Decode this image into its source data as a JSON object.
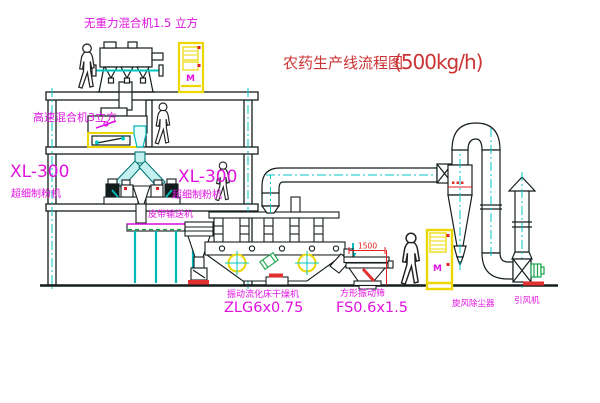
{
  "title": {
    "name": "农药生产线流程图",
    "capacity": "(500kg/h)"
  },
  "labels": {
    "gravity_mixer": "无重力混合机1.5 立方",
    "high_speed_mixer": "高速混合机3立方",
    "mill_left_model": "XL-300",
    "mill_left_name": "超细制粉机",
    "mill_center_model": "XL-300",
    "mill_center_name": "超细制粉机",
    "belt_conveyor": "皮带输送机",
    "dryer_name": "振动流化床干燥机",
    "dryer_model": "ZLG6x0.75",
    "sieve_name": "方形振动筛",
    "sieve_model": "FS0.6x1.5",
    "sieve_dim": "1500",
    "cyclone": "旋风除尘器",
    "fan": "引风机",
    "motor_mark": "M"
  },
  "colors": {
    "line": "#141d1d",
    "centerline_cyan": "#00c6c6",
    "label_magenta": "#e012e0",
    "title_red": "#cc3333",
    "dimension_red": "#e02020",
    "cabinet_yellow": "#ecd800",
    "motor_green": "#18a34a",
    "base_red": "#e03030"
  }
}
